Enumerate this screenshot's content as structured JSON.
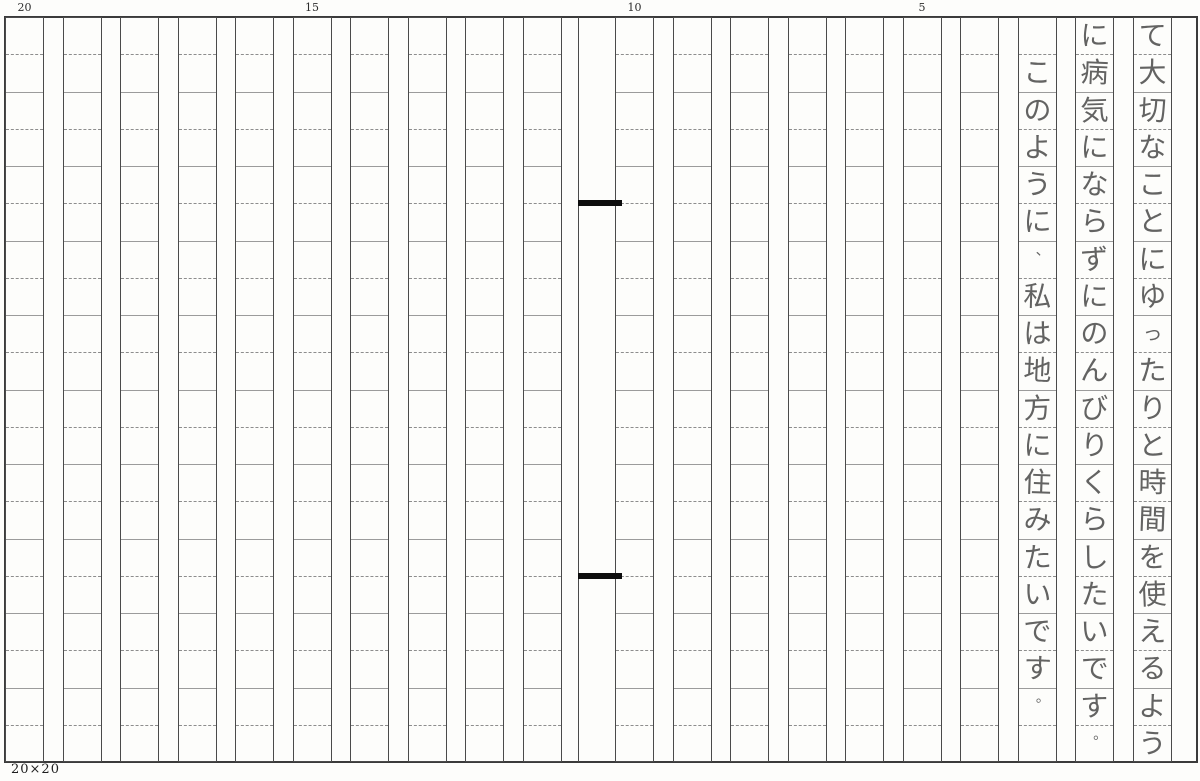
{
  "paper": {
    "size_label": "20×20",
    "grid": {
      "columns": 20,
      "rows": 20
    },
    "ruler_labels": [
      {
        "label": "20",
        "column": 20
      },
      {
        "label": "15",
        "column": 15
      },
      {
        "label": "10",
        "column": 10
      },
      {
        "label": "5",
        "column": 5
      }
    ],
    "binding_marks": [
      {
        "row_boundary": 5
      },
      {
        "row_boundary": 15
      }
    ],
    "colors": {
      "paper": "#fdfdfb",
      "grid_line": "#4a4a4a",
      "cell_divider": "#8d8d8d",
      "ink": "#4e4e4e",
      "binding_mark": "#0d0d0d"
    }
  },
  "handwriting": {
    "columns": [
      {
        "column_from_right": 1,
        "start_row": 1,
        "text": "て大切なことにゆったりと時間を使えるよう"
      },
      {
        "column_from_right": 2,
        "start_row": 1,
        "text": "に病気にならずにのんびりくらしたいです。"
      },
      {
        "column_from_right": 3,
        "start_row": 2,
        "text": "このように、私は地方に住みたいです。"
      }
    ],
    "full_text": "て大切なことにゆったりと時間を使えるように病気にならずにのんびりくらしたいです。このように、私は地方に住みたいです。"
  }
}
